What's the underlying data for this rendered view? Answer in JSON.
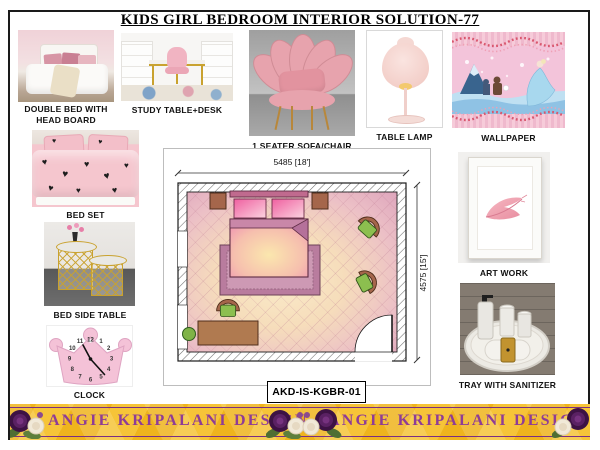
{
  "title": "KIDS GIRL BEDROOM INTERIOR SOLUTION-77",
  "products": [
    {
      "label": "DOUBLE BED WITH HEAD BOARD"
    },
    {
      "label": "STUDY TABLE+DESK"
    },
    {
      "label": "1 SEATER SOFA/CHAIR"
    },
    {
      "label": "TABLE LAMP"
    },
    {
      "label": "WALLPAPER"
    },
    {
      "label": "BED SET"
    },
    {
      "label": "BED SIDE TABLE"
    },
    {
      "label": "CLOCK"
    },
    {
      "label": "ART WORK"
    },
    {
      "label": "TRAY WITH SANITIZER"
    }
  ],
  "floor_plan": {
    "width_dimension": "5485 [18']",
    "height_dimension": "4575 [15']",
    "code": "AKD-IS-KGBR-01"
  },
  "clock": {
    "numbers": [
      "12",
      "1",
      "2",
      "3",
      "4",
      "5",
      "6",
      "7",
      "8",
      "9",
      "10",
      "11"
    ]
  },
  "banner": {
    "brand_left": "ANGIE KRIPALANI DESIGN",
    "brand_right": "ANGIE KRIPALANI DESIGN"
  },
  "icons": {
    "heart": "♥"
  },
  "colors": {
    "banner_gold": "#EFB41D",
    "banner_text_purple": "#8E3C96",
    "plan_pink": "#E9B7C6",
    "plan_cream": "#F8E8C6",
    "chair_green": "#8CBF4F",
    "furniture_brown": "#A5664B",
    "sofa_pink": "#E7A3AD"
  }
}
